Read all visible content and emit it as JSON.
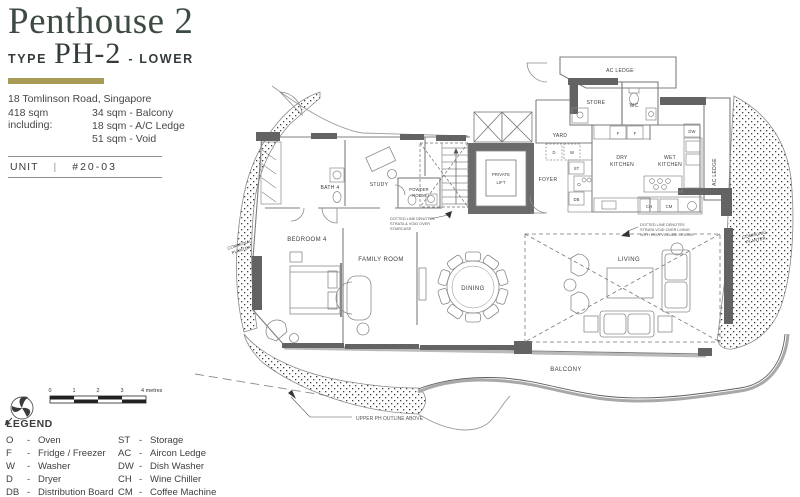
{
  "header": {
    "title": "Penthouse 2",
    "type_prefix": "TYPE",
    "type_code": "PH-2",
    "type_suffix": "- LOWER",
    "address": "18 Tomlinson Road, Singapore",
    "area_label": "418 sqm including:",
    "area_items": [
      "34 sqm - Balcony",
      "18 sqm - A/C Ledge",
      "51 sqm - Void"
    ],
    "unit_label": "UNIT",
    "unit_separator": "|",
    "unit_number": "#20-03"
  },
  "plan": {
    "rooms": {
      "ac_ledge_top": "AC LEDGE",
      "store": "STORE",
      "wc": "WC",
      "yard": "YARD",
      "dry_1": "DRY",
      "dry_2": "KITCHEN",
      "wet_1": "WET",
      "wet_2": "KITCHEN",
      "ac_ledge_right": "AC LEDGE",
      "foyer": "FOYER",
      "private_1": "PRIVATE",
      "private_2": "LIFT",
      "powder_1": "POWDER",
      "powder_2": "ROOM",
      "study": "STUDY",
      "bath4": "BATH 4",
      "bedroom4": "BEDROOM 4",
      "family_room": "FAMILY ROOM",
      "dining": "DINING",
      "living": "LIVING",
      "balcony": "BALCONY"
    },
    "planters": {
      "left_1": "COMMUNAL",
      "left_2": "PLANTER",
      "right_1": "COMMUNAL",
      "right_2": "PLANTER"
    },
    "notes": {
      "stair_1": "DOTTED LINE  DENOTES",
      "stair_2": "STRATA & VOID OVER",
      "stair_3": "STAIRCASE",
      "living_1": "DOTTED LINE DENOTES",
      "living_2": "STRATA VOID OVER LIVING",
      "living_3": "WITH HIGH VOLUME CEILING",
      "upper_outline": "UPPER PH OUTLINE ABOVE"
    },
    "tags": {
      "d": "D",
      "w": "W",
      "st": "ST",
      "db": "DB",
      "o": "O",
      "f": "F",
      "dw": "DW",
      "ch": "CH",
      "cm": "CM"
    }
  },
  "scalebar": {
    "ticks": [
      "0",
      "1",
      "2",
      "3"
    ],
    "end_label": "4 metres"
  },
  "legend": {
    "title": "LEGEND",
    "separator": "-",
    "col1": [
      {
        "abbr": "O",
        "desc": "Oven"
      },
      {
        "abbr": "F",
        "desc": "Fridge / Freezer"
      },
      {
        "abbr": "W",
        "desc": "Washer"
      },
      {
        "abbr": "D",
        "desc": "Dryer"
      },
      {
        "abbr": "DB",
        "desc": "Distribution Board"
      }
    ],
    "col2": [
      {
        "abbr": "ST",
        "desc": "Storage"
      },
      {
        "abbr": "AC",
        "desc": "Aircon Ledge"
      },
      {
        "abbr": "DW",
        "desc": "Dish Washer"
      },
      {
        "abbr": "CH",
        "desc": "Wine Chiller"
      },
      {
        "abbr": "CM",
        "desc": "Coffee Machine"
      }
    ]
  },
  "colors": {
    "title_green": "#3d4b43",
    "accent_gold": "#a69a54",
    "wall_dark": "#636363",
    "wall_mid": "#9a9a9a"
  }
}
